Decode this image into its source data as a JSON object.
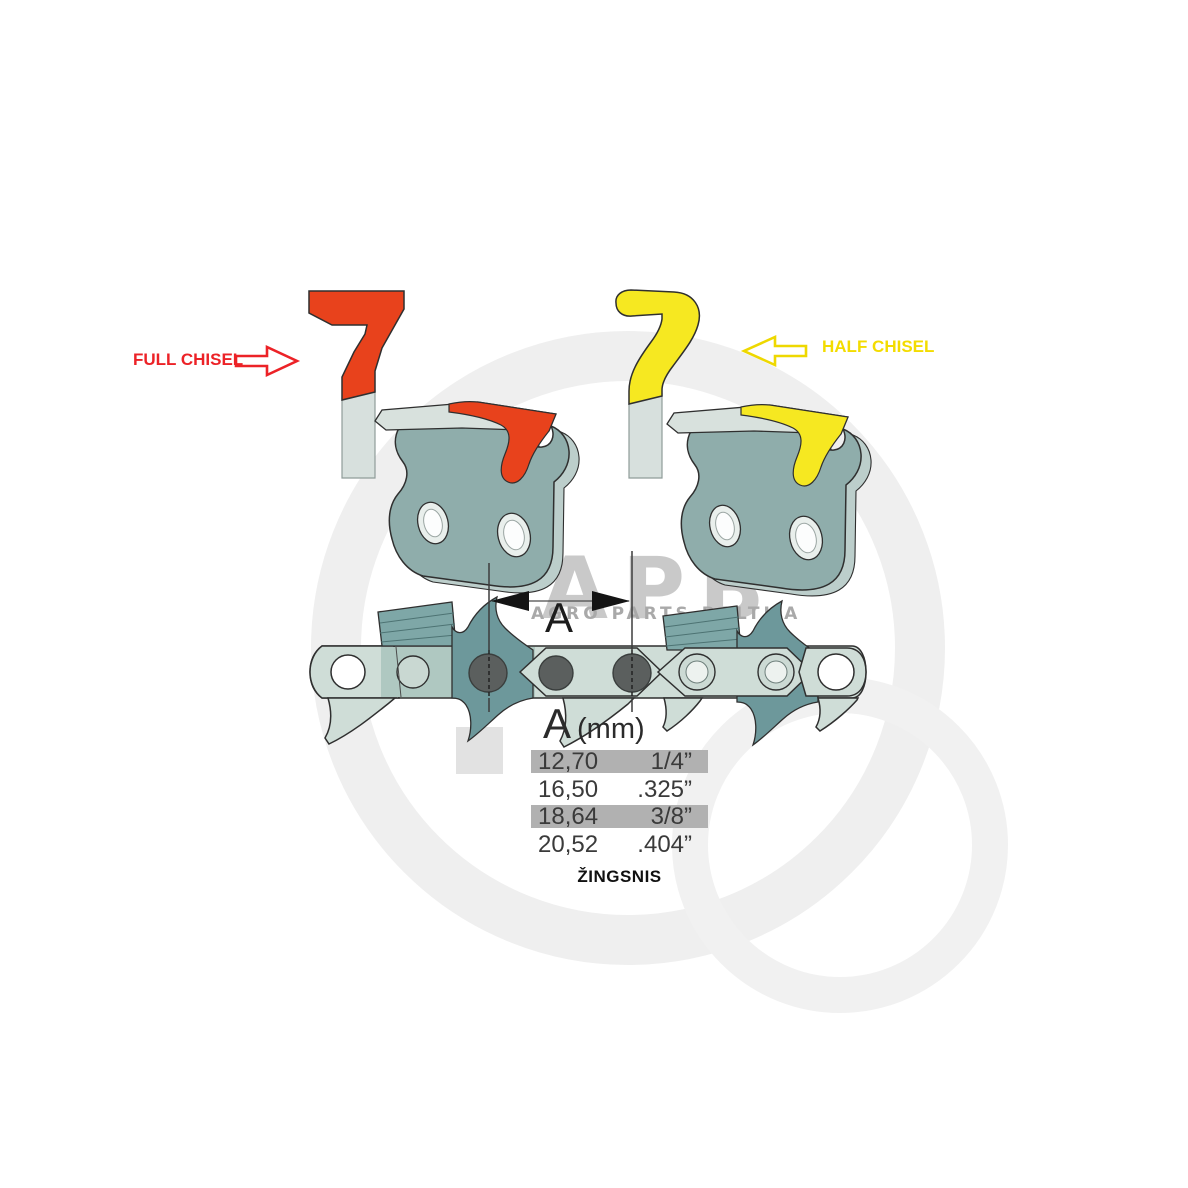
{
  "title": "Chainsaw chain pitch diagram",
  "labels": {
    "full_chisel": "FULL CHISEL",
    "half_chisel": "HALF CHISEL",
    "dimension": "A",
    "pitch_caption": "ŽINGSNIS"
  },
  "table": {
    "header": {
      "symbol": "A",
      "unit": "(mm)"
    },
    "rows": [
      {
        "mm": "12,70",
        "inch": "1/4”",
        "highlighted": true
      },
      {
        "mm": "16,50",
        "inch": ".325”",
        "highlighted": false
      },
      {
        "mm": "18,64",
        "inch": "3/8”",
        "highlighted": true
      },
      {
        "mm": "20,52",
        "inch": ".404”",
        "highlighted": false
      }
    ]
  },
  "watermark": {
    "logo": "APB",
    "subtitle": "AGRO PARTS BALTIJA"
  },
  "icons": {
    "full_chisel_arrow": "right-arrow-icon",
    "half_chisel_arrow": "left-arrow-icon"
  },
  "colors": {
    "full-chisel": "#e8421c",
    "full-chisel-text": "#ec2227",
    "half-chisel": "#f6e821",
    "half-chisel-text": "#f3dc00",
    "strap": "#cfddd7",
    "strap-tint": "#afc8c1",
    "plate": "#8fadab",
    "plate-shade": "#bccecb",
    "tooth-dark": "#6d989b",
    "hatch-plate": "#7ea7a7",
    "rivet": "#5b5f5e",
    "outline": "#2f2f2f",
    "table-highlight": "#b1b1b1",
    "text-dark": "#2b2b2b",
    "watermark-ring": "#efefef",
    "watermark-text": "#c9c9c9",
    "watermark-subtext": "#a9a9a9"
  }
}
